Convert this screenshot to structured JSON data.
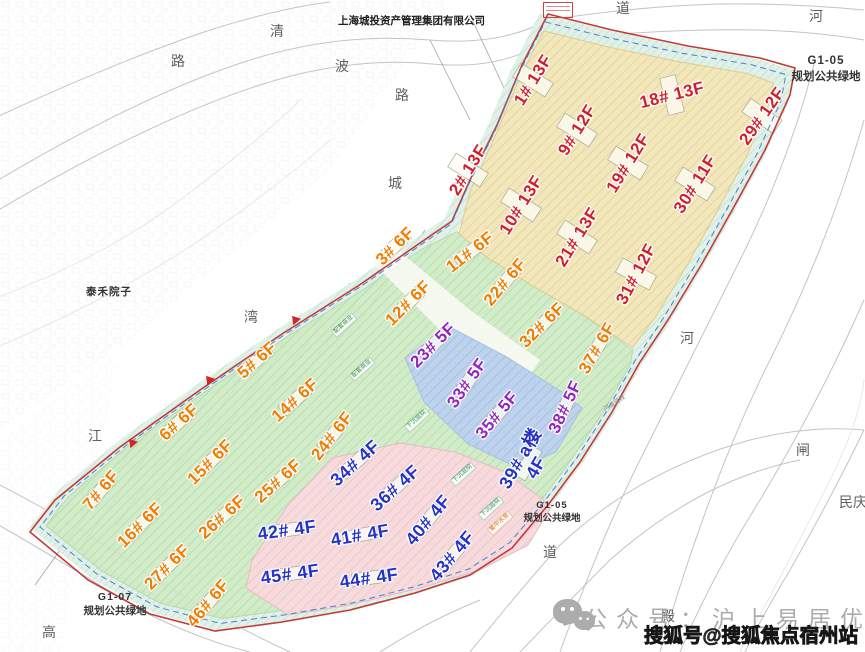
{
  "company_note": "上海城投资产管理集团有限公司",
  "neighbor_label": "泰禾院子",
  "green_spaces": {
    "top_right": {
      "code": "G1-05",
      "name": "规划公共绿地"
    },
    "bottom_center": {
      "code": "G1-05",
      "name": "规划公共绿地"
    },
    "bottom_left": {
      "code": "G1-07",
      "name": "规划公共绿地"
    }
  },
  "legend_colors": {
    "highrise_label": "#cf1f2a",
    "midrise_label": "#f07d00",
    "lowrise5_label": "#9127bd",
    "lowrise4_label": "#2733c8",
    "zone_yellow": "#f2e7bb",
    "zone_green": "#cdeac4",
    "zone_blue": "#bdd2ec",
    "zone_pink": "#f6dadc",
    "buffer_cyan": "#cfe9db",
    "boundary_red": "#c23b3b",
    "boundary_blue_dash": "#4a7fd6"
  },
  "buildings": [
    {
      "label": "1#",
      "floors": "13F",
      "color": "red",
      "x": 533,
      "y": 80,
      "r": -58
    },
    {
      "label": "2#",
      "floors": "13F",
      "color": "red",
      "x": 468,
      "y": 170,
      "r": -58
    },
    {
      "label": "9#",
      "floors": "12F",
      "color": "red",
      "x": 577,
      "y": 130,
      "r": -58
    },
    {
      "label": "10#",
      "floors": "13F",
      "color": "red",
      "x": 521,
      "y": 205,
      "r": -58
    },
    {
      "label": "18#",
      "floors": "13F",
      "color": "red",
      "x": 672,
      "y": 95,
      "r": -14
    },
    {
      "label": "19#",
      "floors": "12F",
      "color": "red",
      "x": 628,
      "y": 163,
      "r": -58
    },
    {
      "label": "21#",
      "floors": "13F",
      "color": "red",
      "x": 577,
      "y": 237,
      "r": -58
    },
    {
      "label": "29#",
      "floors": "12F",
      "color": "red",
      "x": 762,
      "y": 116,
      "r": -55
    },
    {
      "label": "30#",
      "floors": "11F",
      "color": "red",
      "x": 695,
      "y": 184,
      "r": -58
    },
    {
      "label": "31#",
      "floors": "12F",
      "color": "red",
      "x": 636,
      "y": 274,
      "r": -62
    },
    {
      "label": "3#",
      "floors": "6F",
      "color": "orange",
      "x": 395,
      "y": 246,
      "r": -45
    },
    {
      "label": "5#",
      "floors": "6F",
      "color": "orange",
      "x": 257,
      "y": 360,
      "r": -42
    },
    {
      "label": "6#",
      "floors": "6F",
      "color": "orange",
      "x": 179,
      "y": 422,
      "r": -42
    },
    {
      "label": "7#",
      "floors": "6F",
      "color": "orange",
      "x": 101,
      "y": 490,
      "r": -50
    },
    {
      "label": "11#",
      "floors": "6F",
      "color": "orange",
      "x": 470,
      "y": 252,
      "r": -38
    },
    {
      "label": "12#",
      "floors": "6F",
      "color": "orange",
      "x": 408,
      "y": 303,
      "r": -45
    },
    {
      "label": "14#",
      "floors": "6F",
      "color": "orange",
      "x": 295,
      "y": 400,
      "r": -42
    },
    {
      "label": "15#",
      "floors": "6F",
      "color": "orange",
      "x": 210,
      "y": 462,
      "r": -45
    },
    {
      "label": "16#",
      "floors": "6F",
      "color": "orange",
      "x": 140,
      "y": 525,
      "r": -45
    },
    {
      "label": "22#",
      "floors": "6F",
      "color": "orange",
      "x": 505,
      "y": 282,
      "r": -50
    },
    {
      "label": "24#",
      "floors": "6F",
      "color": "orange",
      "x": 332,
      "y": 436,
      "r": -52
    },
    {
      "label": "25#",
      "floors": "6F",
      "color": "orange",
      "x": 278,
      "y": 481,
      "r": -42
    },
    {
      "label": "26#",
      "floors": "6F",
      "color": "orange",
      "x": 222,
      "y": 517,
      "r": -42
    },
    {
      "label": "27#",
      "floors": "6F",
      "color": "orange",
      "x": 167,
      "y": 567,
      "r": -45
    },
    {
      "label": "32#",
      "floors": "6F",
      "color": "orange",
      "x": 542,
      "y": 325,
      "r": -45
    },
    {
      "label": "37#",
      "floors": "6F",
      "color": "orange",
      "x": 597,
      "y": 348,
      "r": -60
    },
    {
      "label": "46#",
      "floors": "6F",
      "color": "orange",
      "x": 208,
      "y": 603,
      "r": -50
    },
    {
      "label": "23#",
      "floors": "5F",
      "color": "purple",
      "x": 433,
      "y": 345,
      "r": -45
    },
    {
      "label": "33#",
      "floors": "5F",
      "color": "purple",
      "x": 467,
      "y": 383,
      "r": -55
    },
    {
      "label": "35#",
      "floors": "5F",
      "color": "purple",
      "x": 497,
      "y": 415,
      "r": -50
    },
    {
      "label": "38#",
      "floors": "5F",
      "color": "purple",
      "x": 565,
      "y": 407,
      "r": -65
    },
    {
      "label": "34#",
      "floors": "4F",
      "color": "blue",
      "x": 355,
      "y": 463,
      "r": -42
    },
    {
      "label": "36#",
      "floors": "4F",
      "color": "blue",
      "x": 395,
      "y": 488,
      "r": -42
    },
    {
      "label": "39# a楼",
      "floors": "4F",
      "color": "blue",
      "x": 528,
      "y": 463,
      "r": -60,
      "two_line": true
    },
    {
      "label": "40#",
      "floors": "4F",
      "color": "blue",
      "x": 428,
      "y": 520,
      "r": -50
    },
    {
      "label": "41#",
      "floors": "4F",
      "color": "blue",
      "x": 360,
      "y": 535,
      "r": -10
    },
    {
      "label": "42#",
      "floors": "4F",
      "color": "blue",
      "x": 287,
      "y": 530,
      "r": -8
    },
    {
      "label": "43#",
      "floors": "4F",
      "color": "blue",
      "x": 452,
      "y": 556,
      "r": -50
    },
    {
      "label": "44#",
      "floors": "4F",
      "color": "blue",
      "x": 369,
      "y": 578,
      "r": -8
    },
    {
      "label": "45#",
      "floors": "4F",
      "color": "blue",
      "x": 290,
      "y": 574,
      "r": -8
    }
  ],
  "road_river_labels": [
    {
      "text": "清",
      "x": 277,
      "y": 31
    },
    {
      "text": "波",
      "x": 342,
      "y": 66
    },
    {
      "text": "路",
      "x": 402,
      "y": 95
    },
    {
      "text": "路",
      "x": 178,
      "y": 61
    },
    {
      "text": "城",
      "x": 395,
      "y": 183
    },
    {
      "text": "道",
      "x": 623,
      "y": 8
    },
    {
      "text": "河",
      "x": 816,
      "y": 16
    },
    {
      "text": "河",
      "x": 687,
      "y": 338
    },
    {
      "text": "湾",
      "x": 251,
      "y": 317
    },
    {
      "text": "江",
      "x": 95,
      "y": 436
    },
    {
      "text": "高",
      "x": 49,
      "y": 632
    },
    {
      "text": "道",
      "x": 550,
      "y": 552
    },
    {
      "text": "殿",
      "x": 668,
      "y": 616
    },
    {
      "text": "闸",
      "x": 803,
      "y": 450
    },
    {
      "text": "民庆",
      "x": 853,
      "y": 502
    }
  ],
  "site_annotations": [
    {
      "text": "配套商业",
      "x": 344,
      "y": 325,
      "r": -42,
      "tone": "green"
    },
    {
      "text": "配套商业",
      "x": 362,
      "y": 369,
      "r": -42,
      "tone": "green"
    },
    {
      "text": "下沉庭院",
      "x": 417,
      "y": 420,
      "r": -42,
      "tone": "green"
    },
    {
      "text": "下沉庭院",
      "x": 463,
      "y": 474,
      "r": -42,
      "tone": "green"
    },
    {
      "text": "下沉庭院",
      "x": 491,
      "y": 508,
      "r": -42,
      "tone": "green"
    },
    {
      "text": "集中水景",
      "x": 500,
      "y": 523,
      "r": -42,
      "tone": "orange"
    },
    {
      "text": "河道蓝线",
      "x": 615,
      "y": 404,
      "r": -33,
      "tone": "gray"
    }
  ],
  "watermark": {
    "wechat_prefix": "公众号",
    "separator": "：",
    "wechat_name": "沪上易居优选",
    "sohu_text": "搜狐号@搜狐焦点宿州站"
  }
}
